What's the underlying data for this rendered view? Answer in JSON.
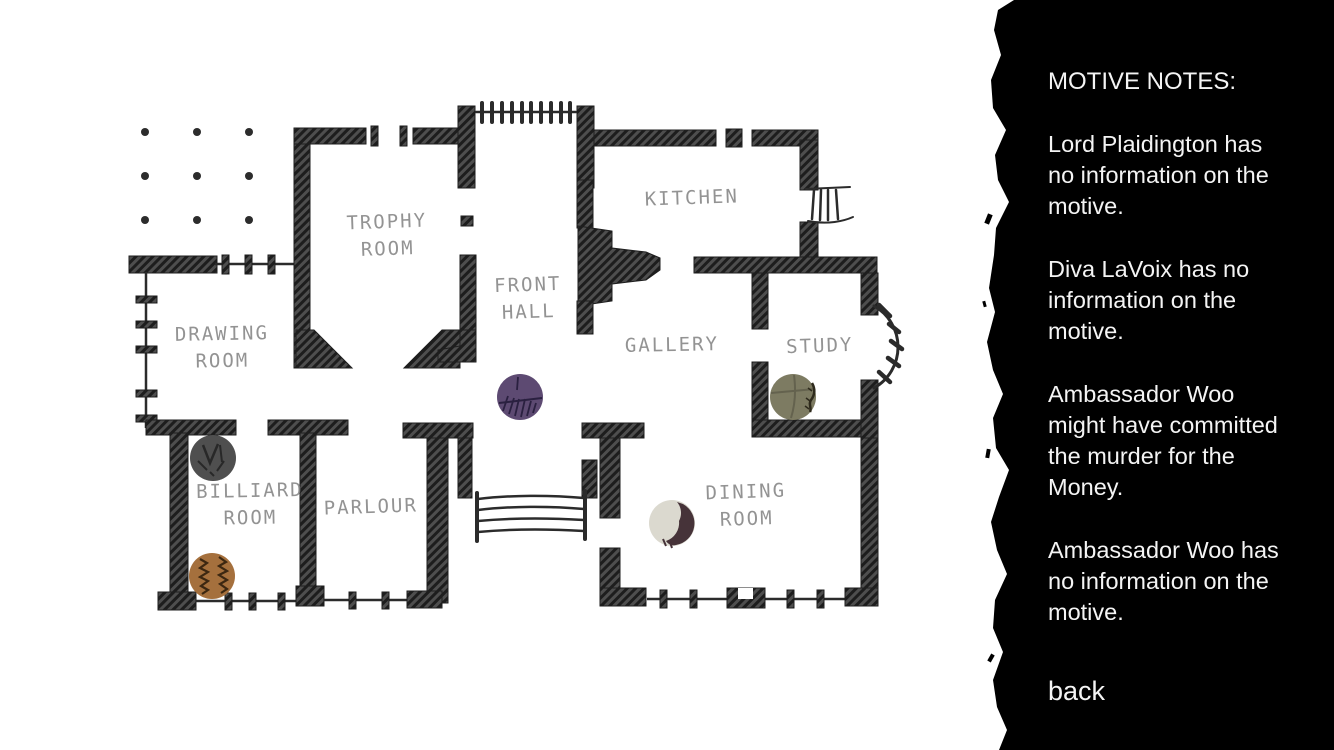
{
  "sidebar": {
    "title": "MOTIVE NOTES:",
    "notes": [
      "Lord Plaidington has\nno information on the\nmotive.",
      "Diva LaVoix has no\ninformation on the\nmotive.",
      "Ambassador Woo\nmight have committed\nthe murder for the\nMoney.",
      "Ambassador Woo has\nno information on the\nmotive."
    ],
    "back_label": "back",
    "background": "#000000",
    "text_color": "#f4f4f4"
  },
  "floorplan": {
    "paper_color": "#ffffff",
    "wall_color": "#2e2e2e",
    "label_color": "#7c7c7c",
    "rooms": [
      {
        "id": "trophy-room",
        "lines": [
          "TROPHY",
          "ROOM"
        ],
        "x": 387,
        "y": 228,
        "tilt": -2
      },
      {
        "id": "kitchen",
        "lines": [
          "KITCHEN"
        ],
        "x": 692,
        "y": 204,
        "tilt": -2
      },
      {
        "id": "front-hall",
        "lines": [
          "FRONT",
          "HALL"
        ],
        "x": 528,
        "y": 291,
        "tilt": -2
      },
      {
        "id": "drawing-room",
        "lines": [
          "DRAWING",
          "ROOM"
        ],
        "x": 222,
        "y": 340,
        "tilt": -1
      },
      {
        "id": "gallery",
        "lines": [
          "GALLERY"
        ],
        "x": 672,
        "y": 351,
        "tilt": -1
      },
      {
        "id": "study",
        "lines": [
          "STUDY"
        ],
        "x": 820,
        "y": 352,
        "tilt": -2
      },
      {
        "id": "billiard-room",
        "lines": [
          "BILLIARD",
          "ROOM"
        ],
        "x": 250,
        "y": 497,
        "tilt": -1
      },
      {
        "id": "parlour",
        "lines": [
          "PARLOUR"
        ],
        "x": 371,
        "y": 513,
        "tilt": -2
      },
      {
        "id": "dining-room",
        "lines": [
          "DINING",
          "ROOM"
        ],
        "x": 746,
        "y": 498,
        "tilt": -2
      }
    ],
    "tokens": [
      {
        "id": "purple",
        "x": 520,
        "y": 397,
        "r": 23,
        "color": "#5d4a72",
        "marks": [
          {
            "d": "M499 403 L542 398",
            "stroke": "#2a2040",
            "w": 2
          },
          {
            "d": "M503 411 L508 396 M509 414 L514 398 M515 416 L519 399 M521 417 L525 399 M527 416 L531 401 M533 413 L536 403 M517 390 L518 377",
            "stroke": "#2a2040",
            "w": 1.8
          }
        ]
      },
      {
        "id": "olive",
        "x": 793,
        "y": 397,
        "r": 23,
        "color": "#7d7b62",
        "marks": [
          {
            "d": "M771 393 L815 389",
            "stroke": "#64624e",
            "w": 2
          },
          {
            "d": "M794 375 C796 390 795 405 791 418",
            "stroke": "#64624e",
            "w": 2
          },
          {
            "d": "M812 383 C816 390 814 396 811 400 C808 404 812 408 810 412",
            "stroke": "#2e2a1c",
            "w": 2.5
          },
          {
            "d": "M808 388 L812 391 M806 398 L810 401 M805 406 L809 409",
            "stroke": "#2e2a1c",
            "w": 1.5
          }
        ]
      },
      {
        "id": "gray",
        "x": 213,
        "y": 458,
        "r": 23,
        "color": "#4f4f4f",
        "marks": [
          {
            "d": "M203 445 L210 463 L218 444",
            "stroke": "#282828",
            "w": 2.5
          },
          {
            "d": "M220 445 L222 462",
            "stroke": "#282828",
            "w": 2
          },
          {
            "d": "M198 461 L207 470 M224 461 L217 471 M210 472 L214 476",
            "stroke": "#282828",
            "w": 2
          }
        ]
      },
      {
        "id": "brown",
        "x": 212,
        "y": 576,
        "r": 23,
        "color": "#a5703d",
        "marks": [
          {
            "d": "M200 559 L207 563 L200 568 L208 572 L200 577 L208 581 L201 586 L208 590 L202 594",
            "stroke": "#3c2711",
            "w": 2.2
          },
          {
            "d": "M219 557 L226 562 L219 566 L227 571 L219 575 L227 580 L220 584 L227 589 L221 593",
            "stroke": "#3c2711",
            "w": 2.2
          }
        ]
      },
      {
        "id": "cream",
        "x": 672,
        "y": 523,
        "r": 23,
        "color": "#dbd9cf",
        "marks": [
          {
            "d": "M683 504 A22 22 0 0 1 676 545 A9 9 0 0 1 666 541 A19 19 0 0 0 679 521 A17 17 0 0 0 677 502 Z",
            "fill": "#463339"
          },
          {
            "d": "M663 539 L666 546 M670 542 L672 548",
            "stroke": "#463339",
            "w": 2
          }
        ]
      }
    ]
  }
}
